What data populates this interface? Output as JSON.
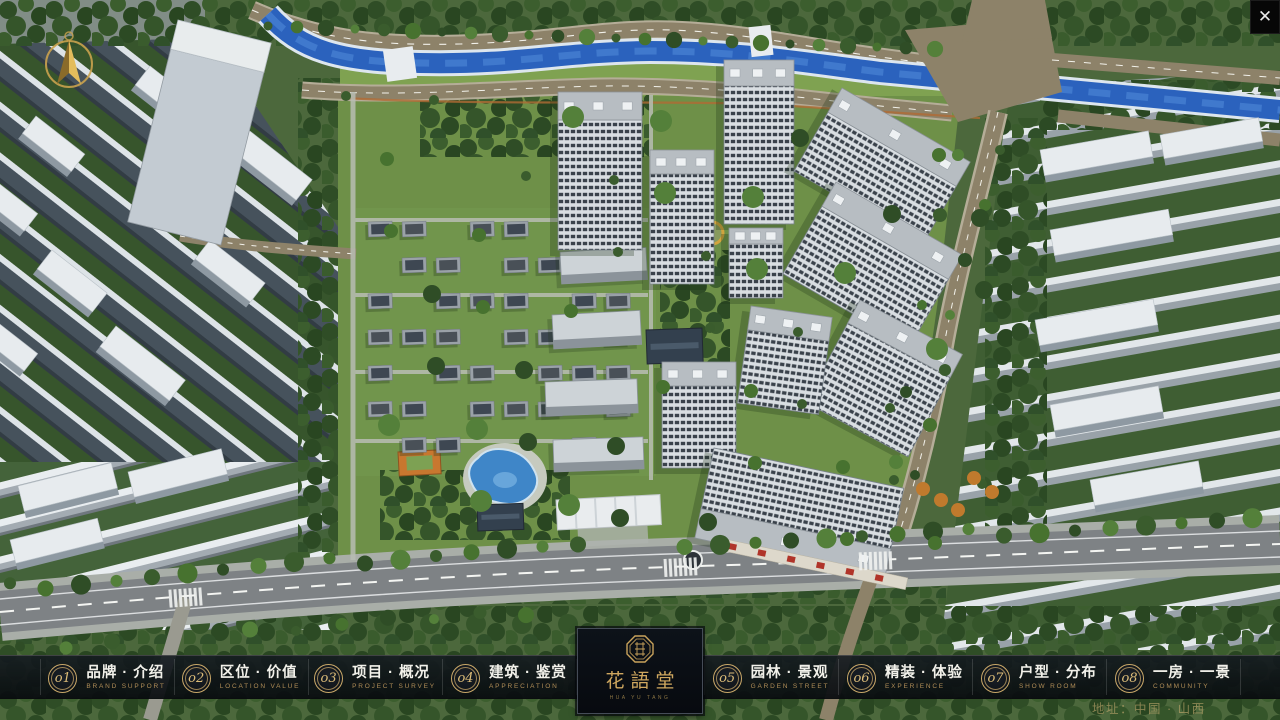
{
  "window": {
    "close_glyph": "✕"
  },
  "logo": {
    "name": "花語堂",
    "subtitle": "HUA YU TANG"
  },
  "menu": {
    "items": [
      {
        "num": "o1",
        "title": "品牌 · 介绍",
        "subtitle": "BRAND SUPPORT"
      },
      {
        "num": "o2",
        "title": "区位 · 价值",
        "subtitle": "LOCATION VALUE"
      },
      {
        "num": "o3",
        "title": "项目 · 概况",
        "subtitle": "PROJECT SURVEY"
      },
      {
        "num": "o4",
        "title": "建筑 · 鉴赏",
        "subtitle": "APPRECIATION"
      },
      {
        "num": "o5",
        "title": "园林 · 景观",
        "subtitle": "GARDEN STREET"
      },
      {
        "num": "o6",
        "title": "精装 · 体验",
        "subtitle": "EXPERIENCE"
      },
      {
        "num": "o7",
        "title": "户型 · 分布",
        "subtitle": "SHOW ROOM"
      },
      {
        "num": "o8",
        "title": "一房 · 一景",
        "subtitle": "COMMUNITY"
      }
    ]
  },
  "footer": {
    "address": "地址：中国 · 山西"
  }
}
